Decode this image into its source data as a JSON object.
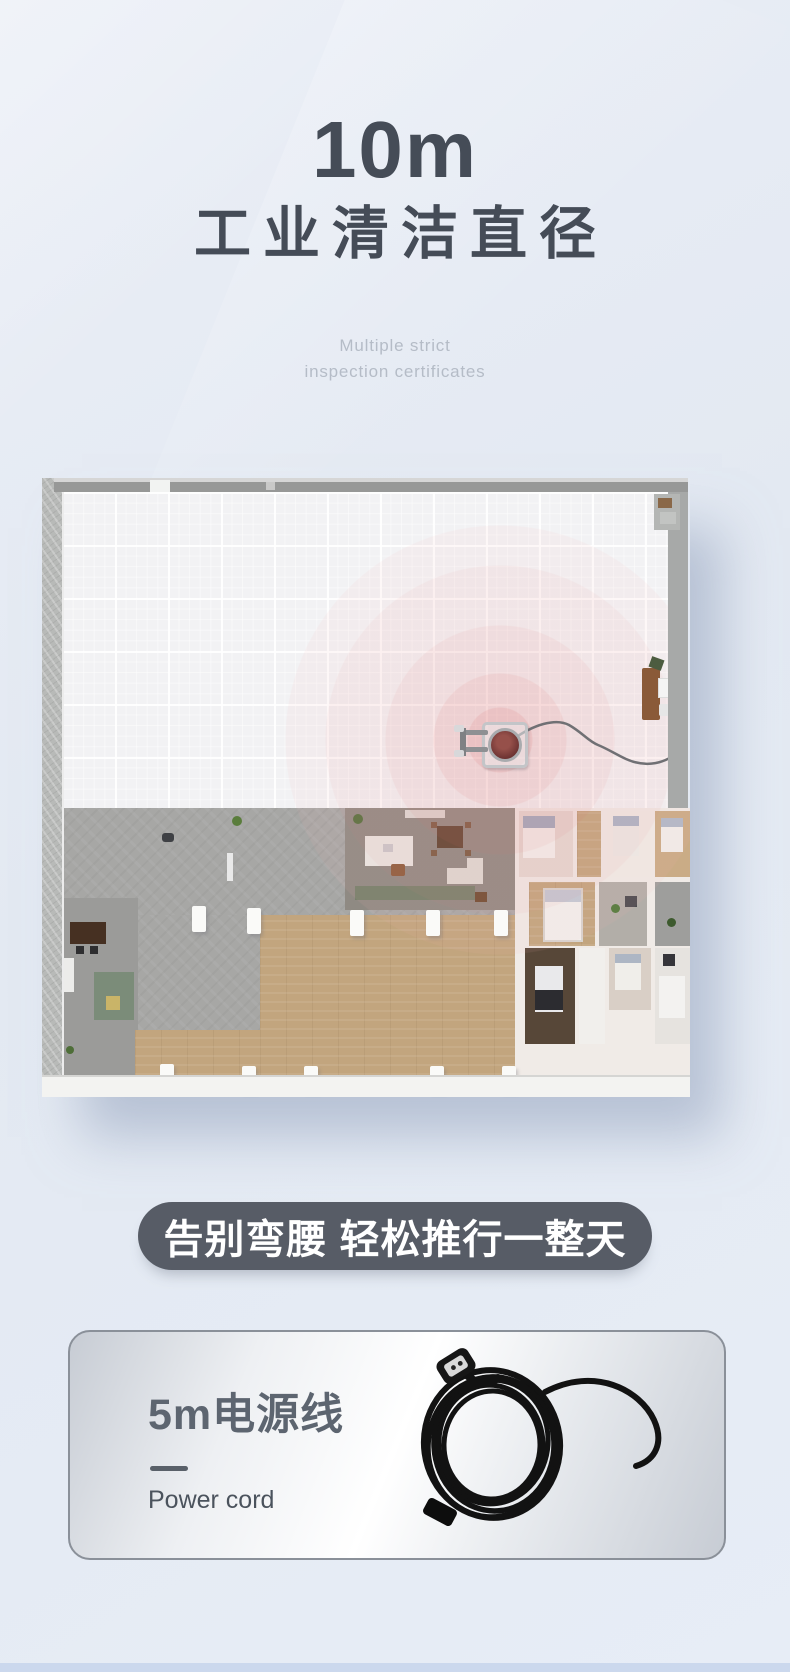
{
  "header": {
    "headline_value": "10m",
    "headline_title": "工业清洁直径",
    "subtitle_line1": "Multiple strict",
    "subtitle_line2": "inspection certificates"
  },
  "floor_plan": {
    "description": "3D top-view floor plan with red concentric rings showing the cleaning radius around a walk-behind floor scrubber connected by a power cord to the wall",
    "ring_accent_color": "#e07878",
    "machine": "floor-scrubber"
  },
  "banner": {
    "label": "告别弯腰 轻松推行一整天",
    "bg_color": "#575c66",
    "text_color": "#ffffff"
  },
  "feature_card": {
    "title": "5m电源线",
    "subtitle": "Power cord",
    "image": "coiled-power-cord"
  },
  "colors": {
    "page_background": "#e7edf6",
    "heading_text": "#454c57",
    "subtitle_text": "#b5bcc7",
    "card_border": "#8a9099",
    "bottom_bar": "#cbd8ed"
  }
}
